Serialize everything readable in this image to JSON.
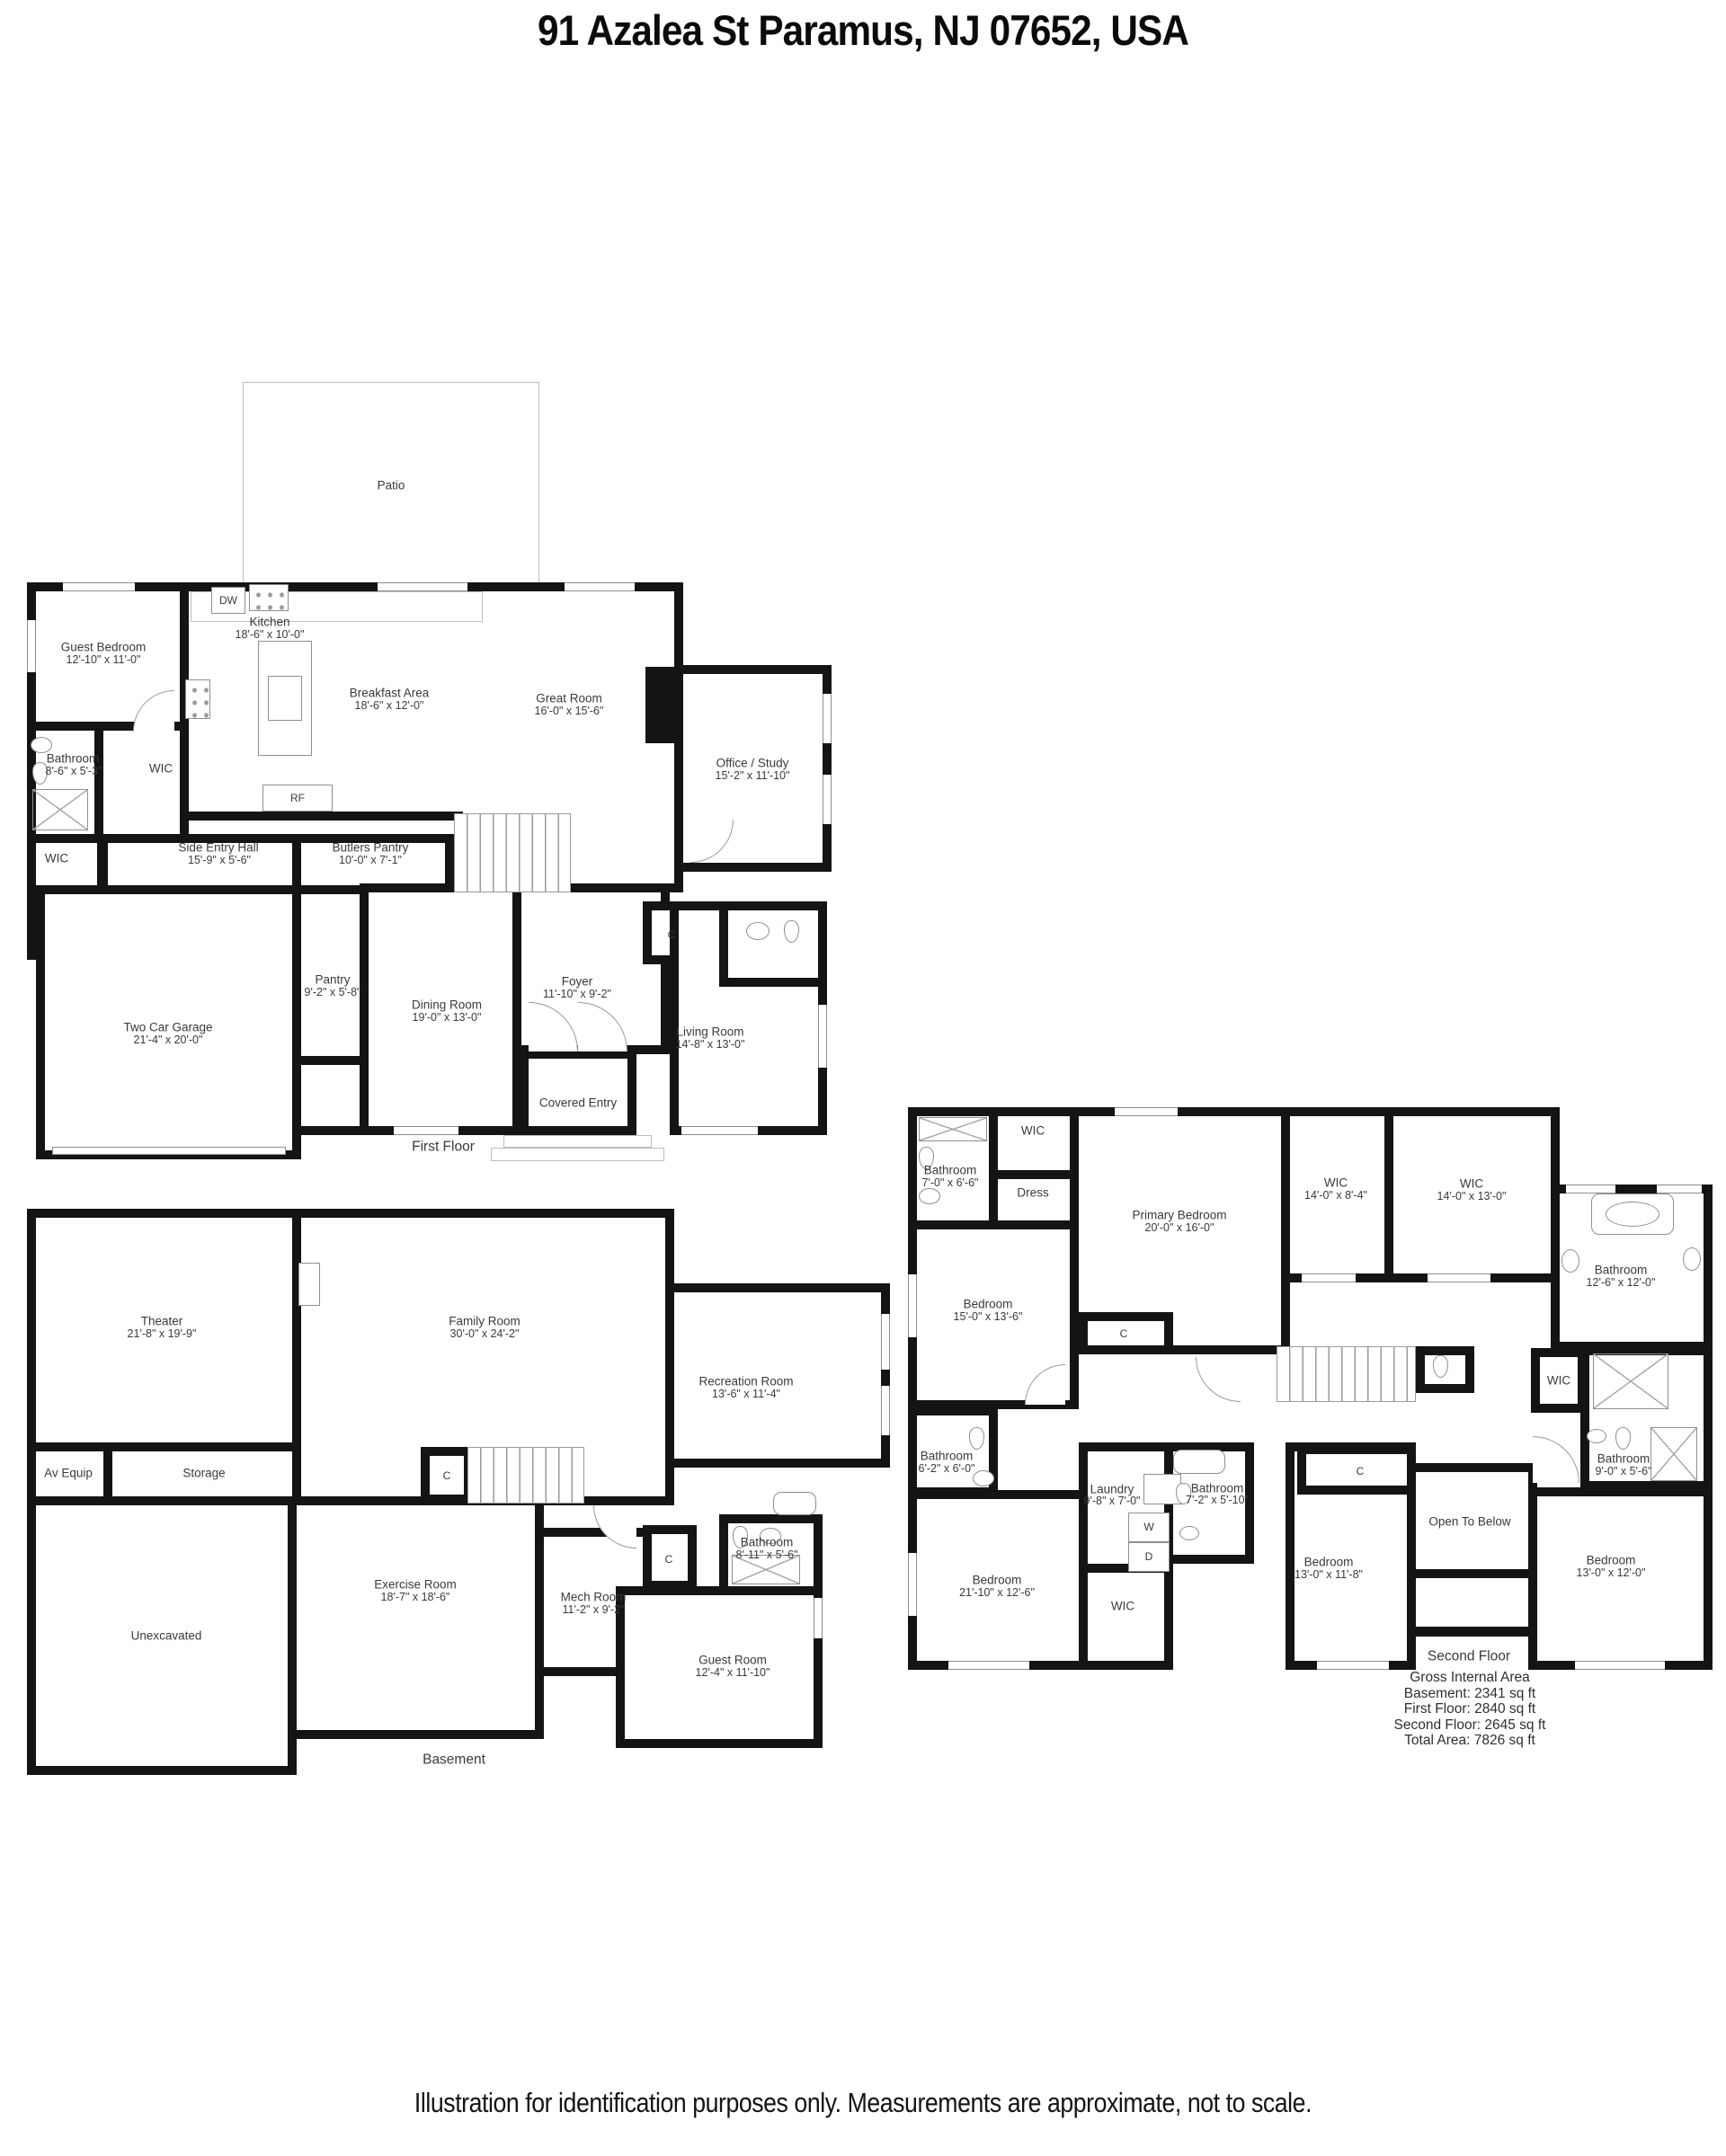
{
  "title": "91 Azalea St Paramus, NJ 07652, USA",
  "footer": "Illustration for identification purposes only. Measurements are approximate, not to scale.",
  "colors": {
    "wall": "#141414",
    "label": "#3a3a3a",
    "fixture_line": "#9a9a9a"
  },
  "first_floor": {
    "floor_label": "First Floor",
    "patio": {
      "name": "Patio"
    },
    "guest_bedroom": {
      "name": "Guest Bedroom",
      "dims": "12'-10\" x 11'-0\""
    },
    "kitchen": {
      "name": "Kitchen",
      "dims": "18'-6\" x 10'-0\""
    },
    "breakfast_area": {
      "name": "Breakfast Area",
      "dims": "18'-6\" x 12'-0\""
    },
    "great_room": {
      "name": "Great Room",
      "dims": "16'-0\" x 15'-6\""
    },
    "office_study": {
      "name": "Office / Study",
      "dims": "15'-2\" x 11'-10\""
    },
    "bathroom": {
      "name": "Bathroom",
      "dims": "8'-6\" x 5'-3\""
    },
    "wic_bedroom": {
      "name": "WIC"
    },
    "wic_hall": {
      "name": "WIC"
    },
    "side_entry_hall": {
      "name": "Side Entry Hall",
      "dims": "15'-9\" x 5'-6\""
    },
    "butlers_pantry": {
      "name": "Butlers Pantry",
      "dims": "10'-0\" x 7'-1\""
    },
    "pantry": {
      "name": "Pantry",
      "dims": "9'-2\" x 5'-8\""
    },
    "dining_room": {
      "name": "Dining Room",
      "dims": "19'-0\" x 13'-0\""
    },
    "foyer": {
      "name": "Foyer",
      "dims": "11'-10\" x 9'-2\""
    },
    "living_room": {
      "name": "Living Room",
      "dims": "14'-8\" x 13'-0\""
    },
    "garage": {
      "name": "Two Car Garage",
      "dims": "21'-4\" x 20'-0\""
    },
    "covered_entry": {
      "name": "Covered Entry"
    },
    "closet": {
      "name": "C"
    },
    "appliance_dw": {
      "name": "DW"
    },
    "appliance_rf": {
      "name": "RF"
    }
  },
  "basement": {
    "floor_label": "Basement",
    "theater": {
      "name": "Theater",
      "dims": "21'-8\" x 19'-9\""
    },
    "av_equip": {
      "name": "Av Equip"
    },
    "storage": {
      "name": "Storage"
    },
    "closet_stairs": {
      "name": "C"
    },
    "family_room": {
      "name": "Family Room",
      "dims": "30'-0\" x 24'-2\""
    },
    "recreation_room": {
      "name": "Recreation Room",
      "dims": "13'-6\" x 11'-4\""
    },
    "bathroom": {
      "name": "Bathroom",
      "dims": "8'-11\" x 5'-6\""
    },
    "unexcavated": {
      "name": "Unexcavated"
    },
    "exercise_room": {
      "name": "Exercise Room",
      "dims": "18'-7\" x 18'-6\""
    },
    "mech_room": {
      "name": "Mech Room",
      "dims": "11'-2\" x 9'-2\""
    },
    "closet_mech": {
      "name": "C"
    },
    "guest_room": {
      "name": "Guest Room",
      "dims": "12'-4\" x 11'-10\""
    }
  },
  "second_floor": {
    "floor_label": "Second Floor",
    "bathroom_top": {
      "name": "Bathroom",
      "dims": "7'-0\" x 6'-6\""
    },
    "wic_top": {
      "name": "WIC"
    },
    "dress": {
      "name": "Dress"
    },
    "primary_bedroom": {
      "name": "Primary Bedroom",
      "dims": "20'-0\" x 16'-0\""
    },
    "wic_primary_a": {
      "name": "WIC",
      "dims": "14'-0\" x 8'-4\""
    },
    "wic_primary_b": {
      "name": "WIC",
      "dims": "14'-0\" x 13'-0\""
    },
    "bathroom_primary": {
      "name": "Bathroom",
      "dims": "12'-6\" x 12'-0\""
    },
    "bedroom_front": {
      "name": "Bedroom",
      "dims": "15'-0\" x 13'-6\""
    },
    "closet_primary": {
      "name": "C"
    },
    "bathroom_left": {
      "name": "Bathroom",
      "dims": "6'-2\" x 6'-0\""
    },
    "bedroom_left": {
      "name": "Bedroom",
      "dims": "21'-10\" x 12'-6\""
    },
    "laundry": {
      "name": "Laundry",
      "dims": "9'-8\" x 7'-0\""
    },
    "washer": {
      "name": "W"
    },
    "dryer": {
      "name": "D"
    },
    "bathroom_laundry": {
      "name": "Bathroom",
      "dims": "7'-2\" x 5'-10\""
    },
    "wic_hall": {
      "name": "WIC"
    },
    "wic_bedroom_left": {
      "name": "WIC"
    },
    "bedroom_mid": {
      "name": "Bedroom",
      "dims": "13'-0\" x 11'-8\""
    },
    "closet_mid": {
      "name": "C"
    },
    "open_to_below": {
      "name": "Open To Below"
    },
    "bedroom_right": {
      "name": "Bedroom",
      "dims": "13'-0\" x 12'-0\""
    },
    "bathroom_right": {
      "name": "Bathroom",
      "dims": "9'-0\" x 5'-6\""
    }
  },
  "area_summary": {
    "title": "Gross Internal Area",
    "lines": [
      "Basement: 2341 sq ft",
      "First Floor: 2840 sq ft",
      "Second Floor: 2645 sq ft",
      "Total Area: 7826 sq ft"
    ]
  }
}
